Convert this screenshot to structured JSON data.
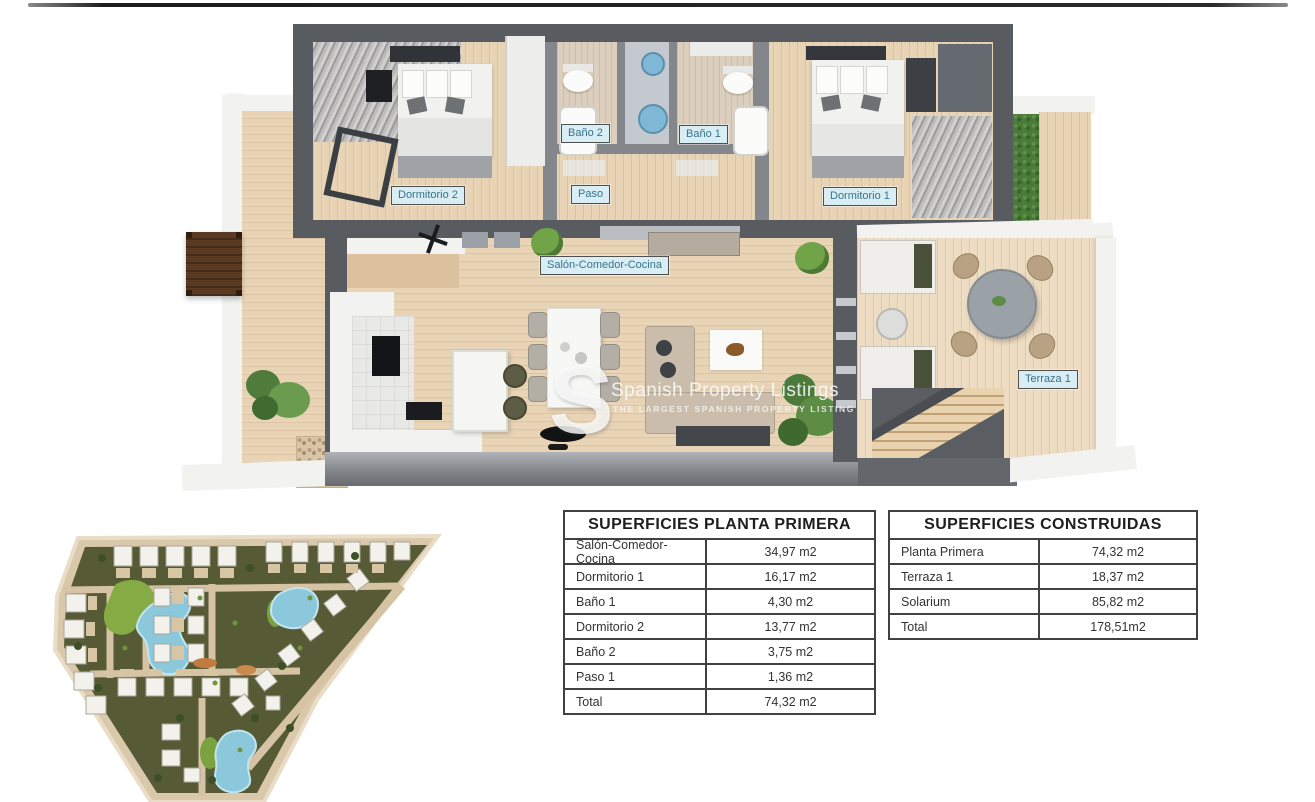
{
  "divider": {
    "note": "thin dark rule at top of page"
  },
  "floor_plan": {
    "room_labels": [
      {
        "id": "dormitorio2",
        "text": "Dormitorio 2"
      },
      {
        "id": "bano2",
        "text": "Baño 2"
      },
      {
        "id": "bano1",
        "text": "Baño 1"
      },
      {
        "id": "paso",
        "text": "Paso"
      },
      {
        "id": "dormitorio1",
        "text": "Dormitorio 1"
      },
      {
        "id": "salon",
        "text": "Salón-Comedor-Cocina"
      },
      {
        "id": "terraza1",
        "text": "Terraza 1"
      }
    ]
  },
  "watermark": {
    "initial": "S",
    "title": "Spanish Property Listings",
    "subtitle": "THE LARGEST SPANISH PROPERTY LISTING"
  },
  "tables": {
    "planta_primera": {
      "title": "SUPERFICIES PLANTA PRIMERA",
      "rows": [
        {
          "label": "Salón-Comedor-Cocina",
          "value": "34,97 m2"
        },
        {
          "label": "Dormitorio 1",
          "value": "16,17 m2"
        },
        {
          "label": "Baño 1",
          "value": "4,30 m2"
        },
        {
          "label": "Dormitorio 2",
          "value": "13,77 m2"
        },
        {
          "label": "Baño 2",
          "value": "3,75 m2"
        },
        {
          "label": "Paso 1",
          "value": "1,36 m2"
        },
        {
          "label": "Total",
          "value": "74,32 m2"
        }
      ]
    },
    "construidas": {
      "title": "SUPERFICIES CONSTRUIDAS",
      "rows": [
        {
          "label": "Planta Primera",
          "value": "74,32 m2"
        },
        {
          "label": "Terraza 1",
          "value": "18,37 m2"
        },
        {
          "label": "Solarium",
          "value": "85,82 m2"
        },
        {
          "label": "Total",
          "value": "178,51m2"
        }
      ]
    }
  },
  "colors": {
    "wall_dark": "#585c60",
    "wood_floor": "#e8d3b5",
    "label_background": "#d9edf4",
    "label_text": "#36748a",
    "table_border": "#414141",
    "siteplan_road": "#dac8ab",
    "siteplan_green": "#565a35",
    "siteplan_lawn": "#85ab44",
    "pool_blue": "#8bc8dc"
  }
}
